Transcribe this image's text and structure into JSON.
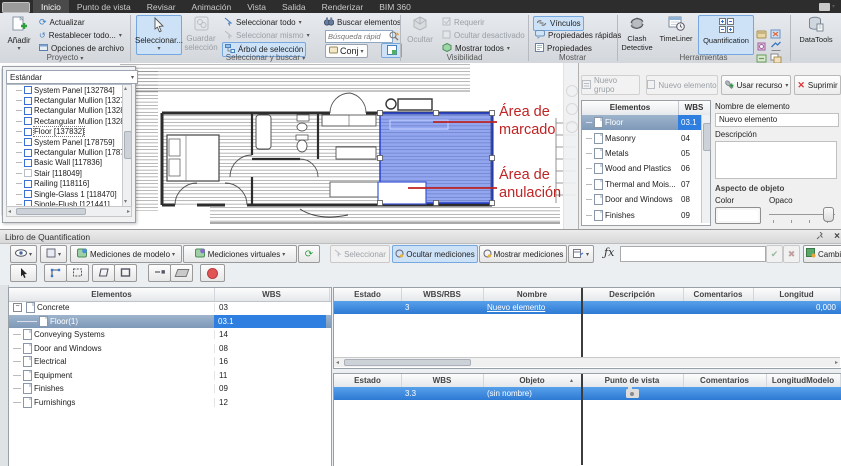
{
  "tabbar": {
    "tabs": [
      "Inicio",
      "Punto de vista",
      "Revisar",
      "Animación",
      "Vista",
      "Salida",
      "Renderizar",
      "BIM 360"
    ]
  },
  "ribbon": {
    "proyecto": {
      "label": "Proyecto",
      "anadir": "Añadir",
      "actualizar": "Actualizar",
      "restablecer": "Restablecer todo...",
      "opciones": "Opciones de archivo"
    },
    "selbuscar": {
      "label": "Seleccionar y buscar",
      "seleccionar": "Seleccionar...",
      "guardar_l1": "Guardar",
      "guardar_l2": "selección",
      "sel_todo": "Seleccionar todo",
      "sel_mismo": "Seleccionar mismo",
      "arbol": "Árbol de selección",
      "buscar": "Buscar elementos",
      "busqueda_placeholder": "Búsqueda rápid",
      "conj": "Conj"
    },
    "visibilidad": {
      "label": "Visibilidad",
      "ocultar": "Ocultar",
      "requerir": "Requerir",
      "ocultar_desactivado": "Ocultar desactivado",
      "mostrar_todos": "Mostrar todos"
    },
    "mostrar": {
      "label": "Mostrar",
      "vinculos": "Vínculos",
      "prop_rapidas": "Propiedades rápidas",
      "propiedades": "Propiedades"
    },
    "herramientas": {
      "label": "Herramientas",
      "clash_l1": "Clash",
      "clash_l2": "Detective",
      "timeliner": "TimeLiner",
      "quantification": "Quantification",
      "datatools": "DataTools"
    }
  },
  "selection_tree": {
    "combo": "Estándar",
    "items": [
      "System Panel [132784]",
      "Rectangular Mullion [132798]",
      "Rectangular Mullion [132803]",
      "Rectangular Mullion [132812]",
      "Floor [137832]",
      "System Panel [178759]",
      "Rectangular Mullion [178787]",
      "Basic Wall [117836]",
      "Stair [118049]",
      "Railing [118116]",
      "Single-Glass 1 [118470]",
      "Single-Flush [121441]",
      "Double-Glass 1 [121"
    ]
  },
  "annotations": {
    "marcado": "Área de marcado",
    "anulacion": "Área de anulación",
    "color": "#bf2323"
  },
  "catalog": {
    "buttons": {
      "nuevo_grupo": "Nuevo grupo",
      "nuevo_elemento": "Nuevo elemento",
      "usar_recurso": "Usar recurso",
      "suprimir": "Suprimir"
    },
    "headers": [
      "Elementos",
      "WBS"
    ],
    "rows": [
      {
        "name": "Floor",
        "wbs": "03.1"
      },
      {
        "name": "Masonry",
        "wbs": "04"
      },
      {
        "name": "Metals",
        "wbs": "05"
      },
      {
        "name": "Wood and Plastics",
        "wbs": "06"
      },
      {
        "name": "Thermal and Mois...",
        "wbs": "07"
      },
      {
        "name": "Door and Windows",
        "wbs": "08"
      },
      {
        "name": "Finishes",
        "wbs": "09"
      }
    ],
    "props": {
      "nombre_label": "Nombre de elemento",
      "nombre_value": "Nuevo elemento",
      "descripcion_label": "Descripción",
      "aspecto_label": "Aspecto de objeto",
      "color_label": "Color",
      "opaco_label": "Opaco"
    }
  },
  "workbook": {
    "title": "Libro de Quantification",
    "toolbar": {
      "med_modelo": "Mediciones de modelo",
      "med_virtuales": "Mediciones virtuales",
      "seleccionar": "Seleccionar",
      "ocultar_mediciones": "Ocultar mediciones",
      "mostrar_mediciones": "Mostrar mediciones",
      "fx": "ƒx",
      "cambiar": "Cambiar análisis"
    },
    "tree": {
      "headers": [
        "Elementos",
        "WBS"
      ],
      "rows": [
        {
          "name": "Concrete",
          "wbs": "03"
        },
        {
          "name": "Floor(1)",
          "wbs": "03.1"
        },
        {
          "name": "Conveying Systems",
          "wbs": "14"
        },
        {
          "name": "Door and Windows",
          "wbs": "08"
        },
        {
          "name": "Electrical",
          "wbs": "16"
        },
        {
          "name": "Equipment",
          "wbs": "11"
        },
        {
          "name": "Finishes",
          "wbs": "09"
        },
        {
          "name": "Furnishings",
          "wbs": "12"
        }
      ]
    },
    "grid_items": {
      "headers": [
        "Estado",
        "WBS/RBS",
        "Nombre",
        "Descripción",
        "Comentarios",
        "Longitud"
      ],
      "row": {
        "estado": "",
        "wbs": "3",
        "nombre": "Nuevo elemento",
        "descripcion": "",
        "comentarios": "",
        "longitud": "0,000"
      }
    },
    "grid_steps": {
      "headers": [
        "Estado",
        "WBS",
        "Objeto",
        "Punto de vista",
        "Comentarios",
        "LongitudModelo"
      ],
      "row": {
        "estado": "",
        "wbs": "3.3",
        "objeto": "(sin nombre)",
        "punto_icon": "camera-icon",
        "comentarios": "",
        "longitud_modelo": ""
      }
    }
  },
  "colors": {
    "selection_blue": "#2e7fe0",
    "markup_blue": "#5070e6",
    "highlight": "#cde2f7",
    "annotation_red": "#bf2323"
  }
}
